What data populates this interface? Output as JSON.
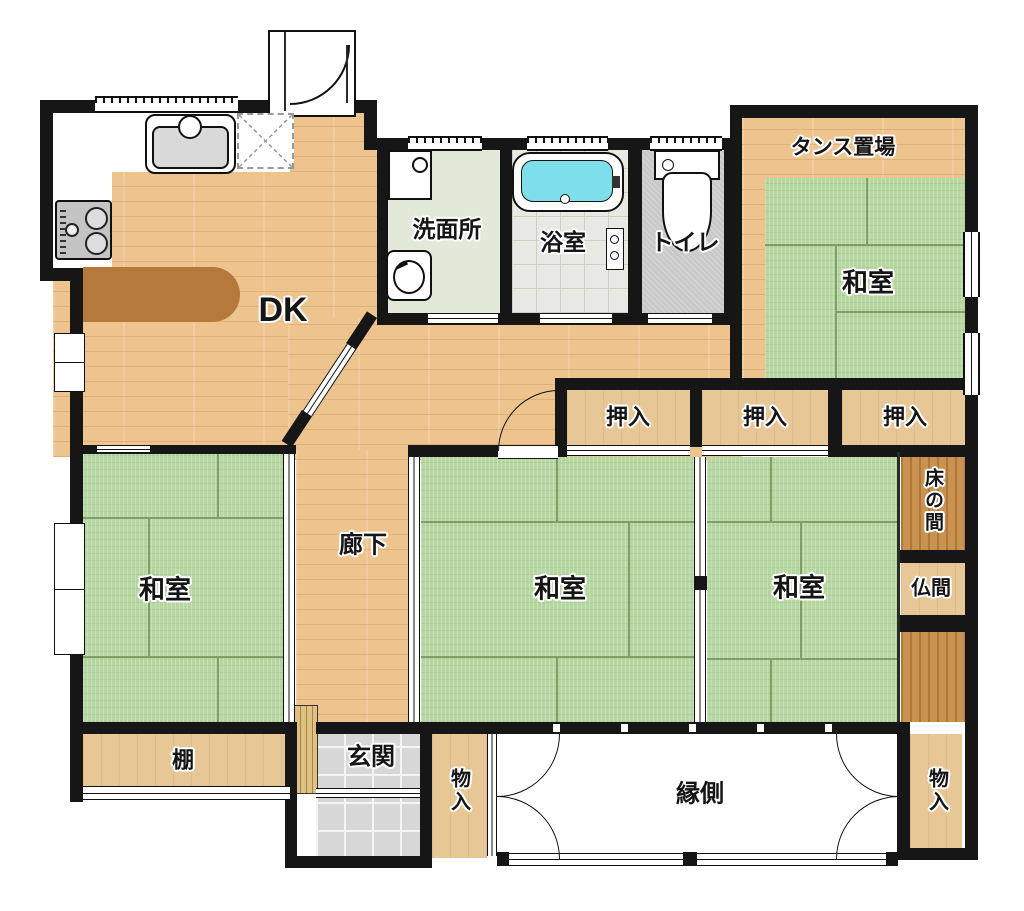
{
  "plan_title": "間取り図",
  "rooms": {
    "dk": {
      "label": "DK"
    },
    "washroom": {
      "label": "洗面所"
    },
    "bath": {
      "label": "浴室"
    },
    "toilet": {
      "label": "トイレ"
    },
    "tansu_area": {
      "label": "タンス置場"
    },
    "washitsu_ne": {
      "label": "和室"
    },
    "oshiire_1": {
      "label": "押入"
    },
    "oshiire_2": {
      "label": "押入"
    },
    "oshiire_3": {
      "label": "押入"
    },
    "tokonoma": {
      "label": "床の間"
    },
    "butsuma": {
      "label": "仏間"
    },
    "corridor": {
      "label": "廊下"
    },
    "washitsu_sw": {
      "label": "和室"
    },
    "washitsu_s": {
      "label": "和室"
    },
    "washitsu_se": {
      "label": "和室"
    },
    "tana": {
      "label": "棚"
    },
    "genkan": {
      "label": "玄関"
    },
    "monoire_center": {
      "label": "物入"
    },
    "engawa": {
      "label": "縁側"
    },
    "monoire_right": {
      "label": "物入"
    }
  },
  "colors": {
    "wall": "#161616",
    "wood_floor": "#edc48e",
    "closet_wood": "#e7c795",
    "dark_wood": "#c9924e",
    "tatami": "#b6d7a1",
    "bath_water": "#7ddfe9",
    "counter": "#b5793c",
    "tile": "#d7d7d7"
  }
}
